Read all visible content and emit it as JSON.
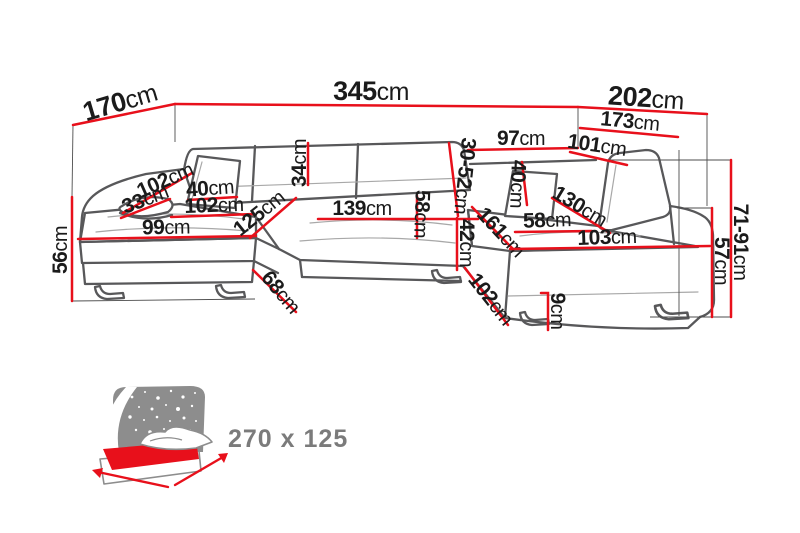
{
  "colors": {
    "dimension_red": "#e8101b",
    "mattress_red": "#e8101b",
    "label_ink": "#1b1b1b",
    "sofa_gray": "#58585a",
    "seam_gray": "#a8a8a8",
    "guide_gray": "#4d4d4d",
    "icon_gray": "#8d8d8d",
    "size_label_gray": "#7b7b7b"
  },
  "measurements": [
    {
      "id": "left-depth",
      "value": "170",
      "unit": "cm"
    },
    {
      "id": "total-width",
      "value": "345",
      "unit": "cm"
    },
    {
      "id": "right-depth",
      "value": "202",
      "unit": "cm"
    },
    {
      "id": "right-inner-length",
      "value": "173",
      "unit": "cm"
    },
    {
      "id": "back-shelf-width",
      "value": "97",
      "unit": "cm"
    },
    {
      "id": "right-back-width",
      "value": "101",
      "unit": "cm"
    },
    {
      "id": "headrest-height-range",
      "value": "30-52",
      "unit": "cm"
    },
    {
      "id": "backrest-cushion-height",
      "value": "34",
      "unit": "cm"
    },
    {
      "id": "left-armrest-cushion-length",
      "value": "102",
      "unit": "cm"
    },
    {
      "id": "left-armrest-width",
      "value": "33",
      "unit": "cm"
    },
    {
      "id": "left-pillow-width",
      "value": "40",
      "unit": "cm"
    },
    {
      "id": "left-seat-width",
      "value": "102",
      "unit": "cm"
    },
    {
      "id": "left-chaise-front-length",
      "value": "99",
      "unit": "cm"
    },
    {
      "id": "left-chaise-depth",
      "value": "125",
      "unit": "cm"
    },
    {
      "id": "center-seat-width",
      "value": "139",
      "unit": "cm"
    },
    {
      "id": "center-seat-depth",
      "value": "58",
      "unit": "cm"
    },
    {
      "id": "front-height",
      "value": "42",
      "unit": "cm"
    },
    {
      "id": "left-seat-height",
      "value": "56",
      "unit": "cm"
    },
    {
      "id": "left-chaise-side-width",
      "value": "68",
      "unit": "cm"
    },
    {
      "id": "right-chaise-side-width",
      "value": "102",
      "unit": "cm"
    },
    {
      "id": "right-pillow-width",
      "value": "40",
      "unit": "cm"
    },
    {
      "id": "right-chaise-length",
      "value": "161",
      "unit": "cm"
    },
    {
      "id": "right-chaise-diagonal",
      "value": "130",
      "unit": "cm"
    },
    {
      "id": "right-seat-depth",
      "value": "58",
      "unit": "cm"
    },
    {
      "id": "right-seat-length",
      "value": "103",
      "unit": "cm"
    },
    {
      "id": "leg-height",
      "value": "9",
      "unit": "cm"
    },
    {
      "id": "right-seat-height",
      "value": "57",
      "unit": "cm"
    },
    {
      "id": "right-back-height-range",
      "value": "71-91",
      "unit": "cm"
    }
  ],
  "sleeping_area": {
    "label": "270 x 125"
  }
}
